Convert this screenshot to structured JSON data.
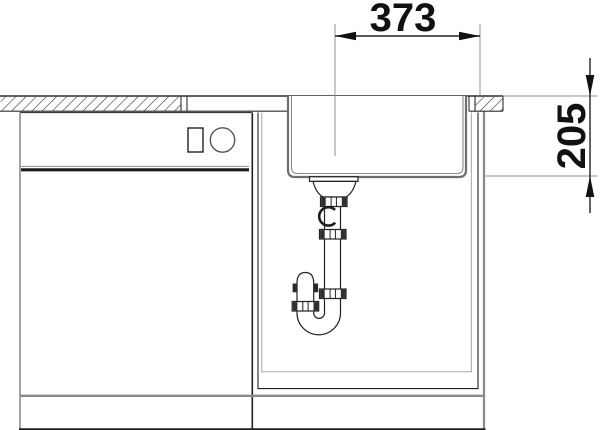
{
  "drawing": {
    "type": "technical-installation-section",
    "subject": "kitchen-sink-with-cabinet-and-siphon",
    "dimensions": {
      "width": {
        "value": "373"
      },
      "depth": {
        "value": "205"
      }
    },
    "colors": {
      "background": "#ffffff",
      "line_dark": "#2a2a2a",
      "line_medium": "#555555",
      "line_gray": "#8a8a8a",
      "text": "#111111"
    }
  }
}
